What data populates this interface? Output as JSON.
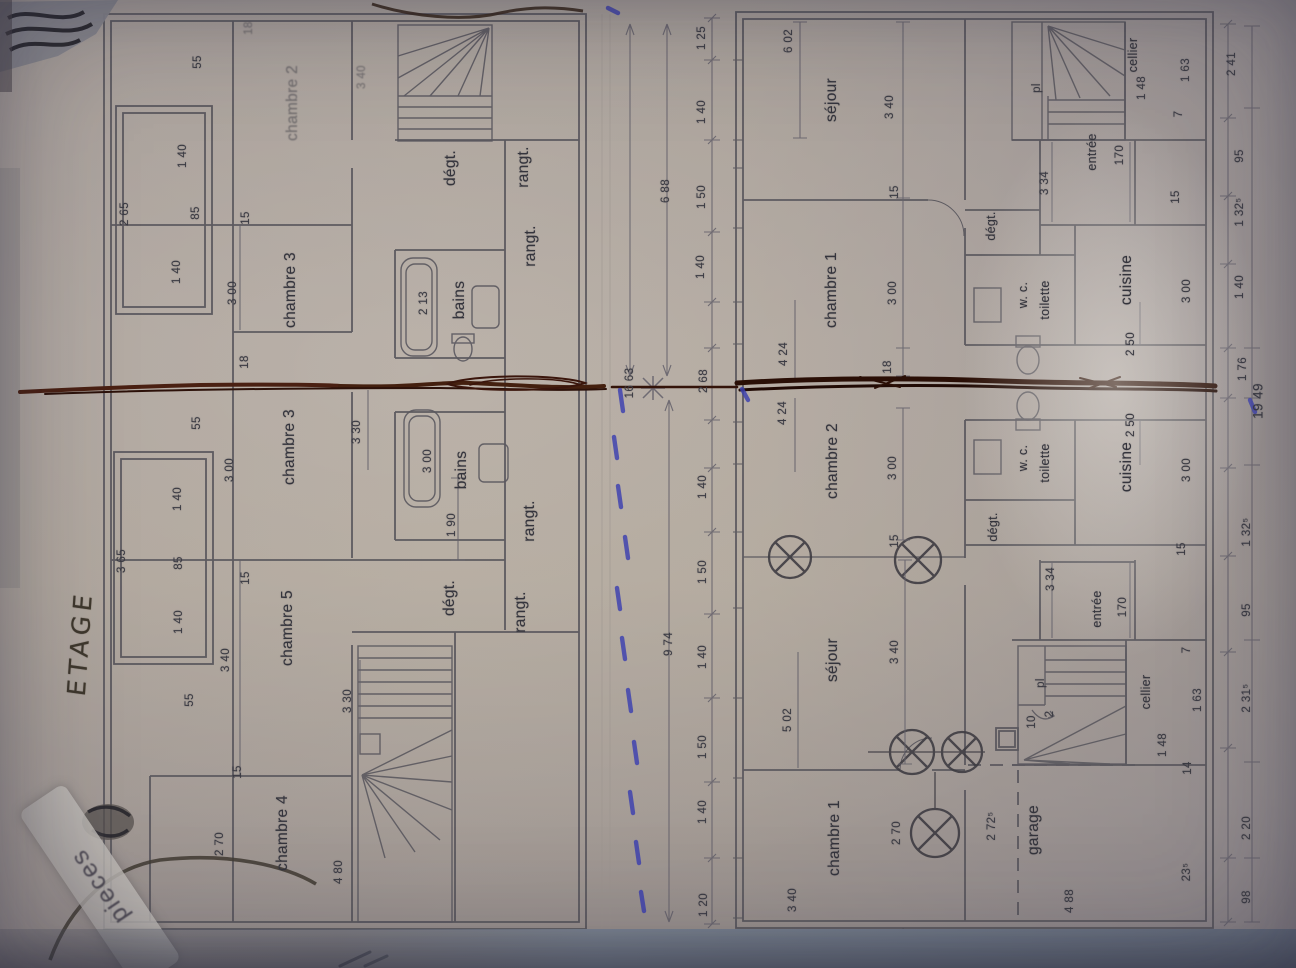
{
  "colors": {
    "paper": "#d3cdc8",
    "plan_ink": "#56545b",
    "fold_ink": "#2a0f06",
    "blue_pen": "#3c40b0"
  },
  "annotations": {
    "title": "ETAGE",
    "stamp": "pieces"
  },
  "left_plan": {
    "name": "ETAGE (upper floor plan)",
    "labels": [
      {
        "text": "chambre 2",
        "x": 293,
        "y": 103,
        "cls": "room faint"
      },
      {
        "text": "3 40",
        "x": 362,
        "y": 77,
        "cls": "dim faint"
      },
      {
        "text": "chambre 3",
        "x": 291,
        "y": 290,
        "cls": "room"
      },
      {
        "text": "chambre 3",
        "x": 290,
        "y": 447,
        "cls": "room"
      },
      {
        "text": "chambre 5",
        "x": 288,
        "y": 628,
        "cls": "room"
      },
      {
        "text": "chambre 4",
        "x": 283,
        "y": 833,
        "cls": "room"
      },
      {
        "text": "bains",
        "x": 460,
        "y": 300,
        "cls": "room"
      },
      {
        "text": "bains",
        "x": 462,
        "y": 470,
        "cls": "room"
      },
      {
        "text": "dégt.",
        "x": 451,
        "y": 168,
        "cls": "room"
      },
      {
        "text": "rangt.",
        "x": 524,
        "y": 167,
        "cls": "room"
      },
      {
        "text": "rangt.",
        "x": 531,
        "y": 246,
        "cls": "room"
      },
      {
        "text": "rangt.",
        "x": 530,
        "y": 521,
        "cls": "room"
      },
      {
        "text": "rangt.",
        "x": 521,
        "y": 612,
        "cls": "room"
      },
      {
        "text": "dégt.",
        "x": 450,
        "y": 598,
        "cls": "room"
      },
      {
        "text": "2 13",
        "x": 424,
        "y": 303,
        "cls": "dim"
      },
      {
        "text": "3 00",
        "x": 428,
        "y": 461,
        "cls": "dim"
      },
      {
        "text": "1 90",
        "x": 452,
        "y": 525,
        "cls": "dim"
      },
      {
        "text": "3 30",
        "x": 357,
        "y": 432,
        "cls": "dim"
      },
      {
        "text": "3 30",
        "x": 348,
        "y": 701,
        "cls": "dim"
      },
      {
        "text": "18",
        "x": 249,
        "y": 28,
        "cls": "dim faint"
      },
      {
        "text": "55",
        "x": 198,
        "y": 62,
        "cls": "dim"
      },
      {
        "text": "1 40",
        "x": 183,
        "y": 156,
        "cls": "dim"
      },
      {
        "text": "85",
        "x": 196,
        "y": 213,
        "cls": "dim"
      },
      {
        "text": "2 65",
        "x": 125,
        "y": 214,
        "cls": "dim"
      },
      {
        "text": "15",
        "x": 246,
        "y": 218,
        "cls": "dim"
      },
      {
        "text": "1 40",
        "x": 177,
        "y": 272,
        "cls": "dim"
      },
      {
        "text": "3 00",
        "x": 233,
        "y": 293,
        "cls": "dim"
      },
      {
        "text": "18",
        "x": 245,
        "y": 362,
        "cls": "dim"
      },
      {
        "text": "55",
        "x": 197,
        "y": 423,
        "cls": "dim"
      },
      {
        "text": "3 00",
        "x": 230,
        "y": 470,
        "cls": "dim"
      },
      {
        "text": "1 40",
        "x": 178,
        "y": 499,
        "cls": "dim"
      },
      {
        "text": "3 65",
        "x": 122,
        "y": 561,
        "cls": "dim"
      },
      {
        "text": "85",
        "x": 179,
        "y": 563,
        "cls": "dim"
      },
      {
        "text": "15",
        "x": 246,
        "y": 578,
        "cls": "dim"
      },
      {
        "text": "1 40",
        "x": 179,
        "y": 622,
        "cls": "dim"
      },
      {
        "text": "3 40",
        "x": 226,
        "y": 660,
        "cls": "dim"
      },
      {
        "text": "55",
        "x": 190,
        "y": 700,
        "cls": "dim"
      },
      {
        "text": "15",
        "x": 238,
        "y": 772,
        "cls": "dim"
      },
      {
        "text": "2 70",
        "x": 220,
        "y": 844,
        "cls": "dim"
      },
      {
        "text": "4 80",
        "x": 339,
        "y": 872,
        "cls": "dim"
      }
    ]
  },
  "center_strip": {
    "labels": [
      {
        "text": "16 63",
        "x": 630,
        "y": 383,
        "cls": "dim"
      },
      {
        "text": "6 88",
        "x": 666,
        "y": 191,
        "cls": "dim"
      },
      {
        "text": "9 74",
        "x": 669,
        "y": 644,
        "cls": "dim"
      },
      {
        "text": "2 68",
        "x": 704,
        "y": 381,
        "cls": "dim"
      },
      {
        "text": "1 25",
        "x": 702,
        "y": 38,
        "cls": "dim"
      },
      {
        "text": "1 40",
        "x": 702,
        "y": 112,
        "cls": "dim"
      },
      {
        "text": "1 50",
        "x": 702,
        "y": 197,
        "cls": "dim"
      },
      {
        "text": "1 40",
        "x": 701,
        "y": 267,
        "cls": "dim"
      },
      {
        "text": "1 40",
        "x": 703,
        "y": 487,
        "cls": "dim"
      },
      {
        "text": "1 50",
        "x": 703,
        "y": 572,
        "cls": "dim"
      },
      {
        "text": "1 40",
        "x": 703,
        "y": 657,
        "cls": "dim"
      },
      {
        "text": "1 50",
        "x": 703,
        "y": 747,
        "cls": "dim"
      },
      {
        "text": "1 40",
        "x": 703,
        "y": 812,
        "cls": "dim"
      },
      {
        "text": "1 20",
        "x": 704,
        "y": 905,
        "cls": "dim"
      }
    ]
  },
  "right_plan": {
    "name": "ground floor plan (two mirrored units)",
    "labels": [
      {
        "text": "6 02",
        "x": 789,
        "y": 41,
        "cls": "dim"
      },
      {
        "text": "séjour",
        "x": 832,
        "y": 100,
        "cls": "room"
      },
      {
        "text": "3 40",
        "x": 890,
        "y": 107,
        "cls": "dim"
      },
      {
        "text": "15",
        "x": 895,
        "y": 192,
        "cls": "dim"
      },
      {
        "text": "chambre 1",
        "x": 832,
        "y": 290,
        "cls": "room"
      },
      {
        "text": "3 00",
        "x": 893,
        "y": 293,
        "cls": "dim"
      },
      {
        "text": "18",
        "x": 888,
        "y": 367,
        "cls": "dim"
      },
      {
        "text": "4 24",
        "x": 784,
        "y": 354,
        "cls": "dim"
      },
      {
        "text": "pl",
        "x": 1037,
        "y": 88,
        "cls": "dim"
      },
      {
        "text": "cellier",
        "x": 1133,
        "y": 55,
        "cls": "room small"
      },
      {
        "text": "1 48",
        "x": 1142,
        "y": 88,
        "cls": "dim"
      },
      {
        "text": "1 63",
        "x": 1186,
        "y": 70,
        "cls": "dim"
      },
      {
        "text": "2 41",
        "x": 1232,
        "y": 64,
        "cls": "dim"
      },
      {
        "text": "7",
        "x": 1179,
        "y": 114,
        "cls": "dim"
      },
      {
        "text": "entrée",
        "x": 1092,
        "y": 152,
        "cls": "room small"
      },
      {
        "text": "170",
        "x": 1120,
        "y": 155,
        "cls": "dim"
      },
      {
        "text": "3 34",
        "x": 1045,
        "y": 183,
        "cls": "dim"
      },
      {
        "text": "dégt.",
        "x": 991,
        "y": 226,
        "cls": "room small"
      },
      {
        "text": "w. c.",
        "x": 1023,
        "y": 295,
        "cls": "room small"
      },
      {
        "text": "toilette",
        "x": 1045,
        "y": 300,
        "cls": "room small"
      },
      {
        "text": "cuisine",
        "x": 1127,
        "y": 280,
        "cls": "room"
      },
      {
        "text": "2 50",
        "x": 1131,
        "y": 344,
        "cls": "dim"
      },
      {
        "text": "3 00",
        "x": 1187,
        "y": 291,
        "cls": "dim"
      },
      {
        "text": "15",
        "x": 1176,
        "y": 197,
        "cls": "dim"
      },
      {
        "text": "95",
        "x": 1240,
        "y": 156,
        "cls": "dim"
      },
      {
        "text": "1 32⁵",
        "x": 1240,
        "y": 212,
        "cls": "dim"
      },
      {
        "text": "1 40",
        "x": 1240,
        "y": 287,
        "cls": "dim"
      },
      {
        "text": "1 76",
        "x": 1243,
        "y": 369,
        "cls": "dim"
      },
      {
        "text": "19 49",
        "x": 1258,
        "y": 401,
        "cls": "dim big"
      },
      {
        "text": "4 24",
        "x": 783,
        "y": 413,
        "cls": "dim"
      },
      {
        "text": "chambre 2",
        "x": 833,
        "y": 461,
        "cls": "room"
      },
      {
        "text": "3 00",
        "x": 893,
        "y": 468,
        "cls": "dim"
      },
      {
        "text": "15",
        "x": 895,
        "y": 541,
        "cls": "dim"
      },
      {
        "text": "séjour",
        "x": 833,
        "y": 660,
        "cls": "room"
      },
      {
        "text": "3 40",
        "x": 895,
        "y": 652,
        "cls": "dim"
      },
      {
        "text": "5 02",
        "x": 788,
        "y": 720,
        "cls": "dim"
      },
      {
        "text": "w. c.",
        "x": 1023,
        "y": 458,
        "cls": "room small"
      },
      {
        "text": "toilette",
        "x": 1045,
        "y": 463,
        "cls": "room small"
      },
      {
        "text": "dégt.",
        "x": 993,
        "y": 527,
        "cls": "room small"
      },
      {
        "text": "3 34",
        "x": 1051,
        "y": 579,
        "cls": "dim"
      },
      {
        "text": "cuisine",
        "x": 1127,
        "y": 467,
        "cls": "room"
      },
      {
        "text": "2 50",
        "x": 1131,
        "y": 425,
        "cls": "dim"
      },
      {
        "text": "3 00",
        "x": 1187,
        "y": 470,
        "cls": "dim"
      },
      {
        "text": "15",
        "x": 1182,
        "y": 549,
        "cls": "dim"
      },
      {
        "text": "1 32⁵",
        "x": 1247,
        "y": 532,
        "cls": "dim"
      },
      {
        "text": "95",
        "x": 1247,
        "y": 610,
        "cls": "dim"
      },
      {
        "text": "entrée",
        "x": 1097,
        "y": 609,
        "cls": "room small"
      },
      {
        "text": "170",
        "x": 1123,
        "y": 607,
        "cls": "dim"
      },
      {
        "text": "7",
        "x": 1187,
        "y": 650,
        "cls": "dim"
      },
      {
        "text": "pl",
        "x": 1041,
        "y": 683,
        "cls": "dim"
      },
      {
        "text": "10",
        "x": 1032,
        "y": 722,
        "cls": "dim"
      },
      {
        "text": "2",
        "x": 1050,
        "y": 714,
        "cls": "dim"
      },
      {
        "text": "cellier",
        "x": 1146,
        "y": 692,
        "cls": "room small"
      },
      {
        "text": "1 63",
        "x": 1198,
        "y": 700,
        "cls": "dim"
      },
      {
        "text": "2 31⁵",
        "x": 1247,
        "y": 698,
        "cls": "dim"
      },
      {
        "text": "1 48",
        "x": 1163,
        "y": 745,
        "cls": "dim"
      },
      {
        "text": "14",
        "x": 1188,
        "y": 768,
        "cls": "dim"
      },
      {
        "text": "garage",
        "x": 1034,
        "y": 830,
        "cls": "room"
      },
      {
        "text": "2 72⁵",
        "x": 992,
        "y": 826,
        "cls": "dim"
      },
      {
        "text": "2 70",
        "x": 897,
        "y": 833,
        "cls": "dim"
      },
      {
        "text": "chambre 1",
        "x": 835,
        "y": 838,
        "cls": "room"
      },
      {
        "text": "3 40",
        "x": 793,
        "y": 900,
        "cls": "dim"
      },
      {
        "text": "2 20",
        "x": 1247,
        "y": 828,
        "cls": "dim"
      },
      {
        "text": "23⁵",
        "x": 1187,
        "y": 872,
        "cls": "dim"
      },
      {
        "text": "98",
        "x": 1247,
        "y": 897,
        "cls": "dim"
      },
      {
        "text": "4 88",
        "x": 1070,
        "y": 901,
        "cls": "dim"
      }
    ]
  }
}
